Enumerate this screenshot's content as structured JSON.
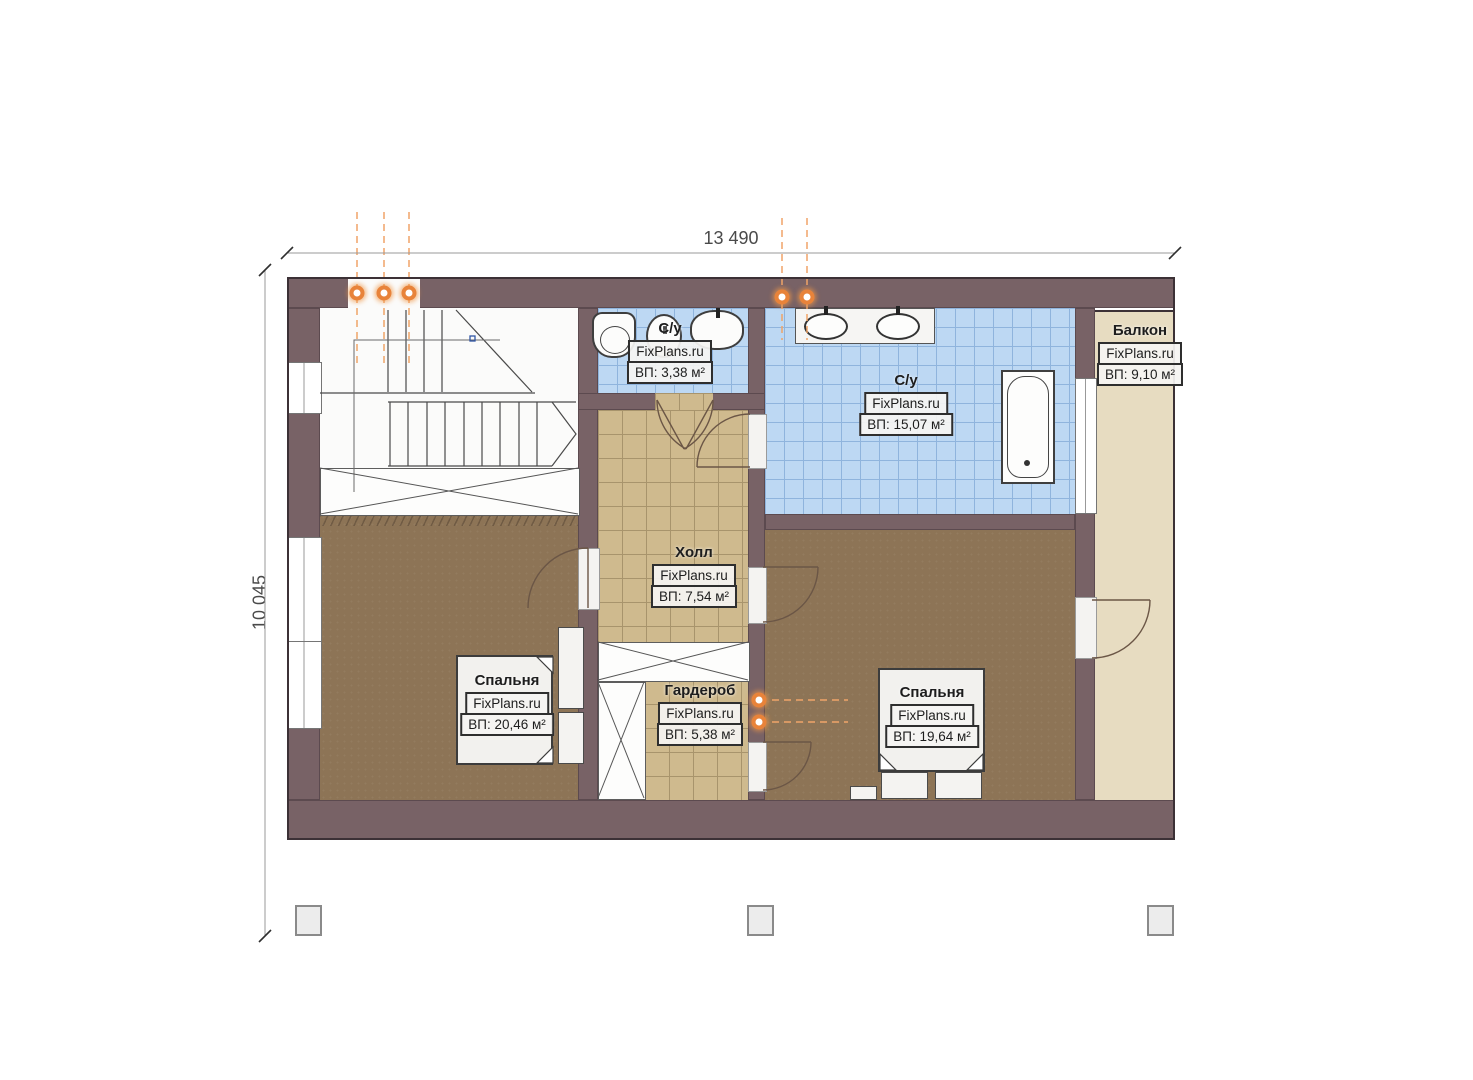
{
  "plan_title": "floor-plan",
  "brand": "FixPlans.ru",
  "dimensions": {
    "width_label": "13 490",
    "height_label": "10 045"
  },
  "rooms": [
    {
      "key": "bathroom-small",
      "name": "С/у",
      "brand": "FixPlans.ru",
      "area": "ВП: 3,38 м²"
    },
    {
      "key": "bathroom-large",
      "name": "С/у",
      "brand": "FixPlans.ru",
      "area": "ВП: 15,07 м²"
    },
    {
      "key": "balcony",
      "name": "Балкон",
      "brand": "FixPlans.ru",
      "area": "ВП: 9,10 м²"
    },
    {
      "key": "hall",
      "name": "Холл",
      "brand": "FixPlans.ru",
      "area": "ВП: 7,54 м²"
    },
    {
      "key": "bedroom-left",
      "name": "Спальня",
      "brand": "FixPlans.ru",
      "area": "ВП: 20,46 м²"
    },
    {
      "key": "wardrobe",
      "name": "Гардероб",
      "brand": "FixPlans.ru",
      "area": "ВП: 5,38 м²"
    },
    {
      "key": "bedroom-right",
      "name": "Спальня",
      "brand": "FixPlans.ru",
      "area": "ВП: 19,64 м²"
    }
  ],
  "colors": {
    "wall": "#786266",
    "tile_blue": "#bdd8f3",
    "tile_blue_grid": "#8fb4dd",
    "tile_beige": "#cfba8e",
    "tile_beige_grid": "#a8946c",
    "floor_wood": "#8d7456",
    "balcony_floor": "#e7dcc1",
    "lamp_accent": "#e8833a",
    "dimension_text": "#4a4a4a"
  }
}
